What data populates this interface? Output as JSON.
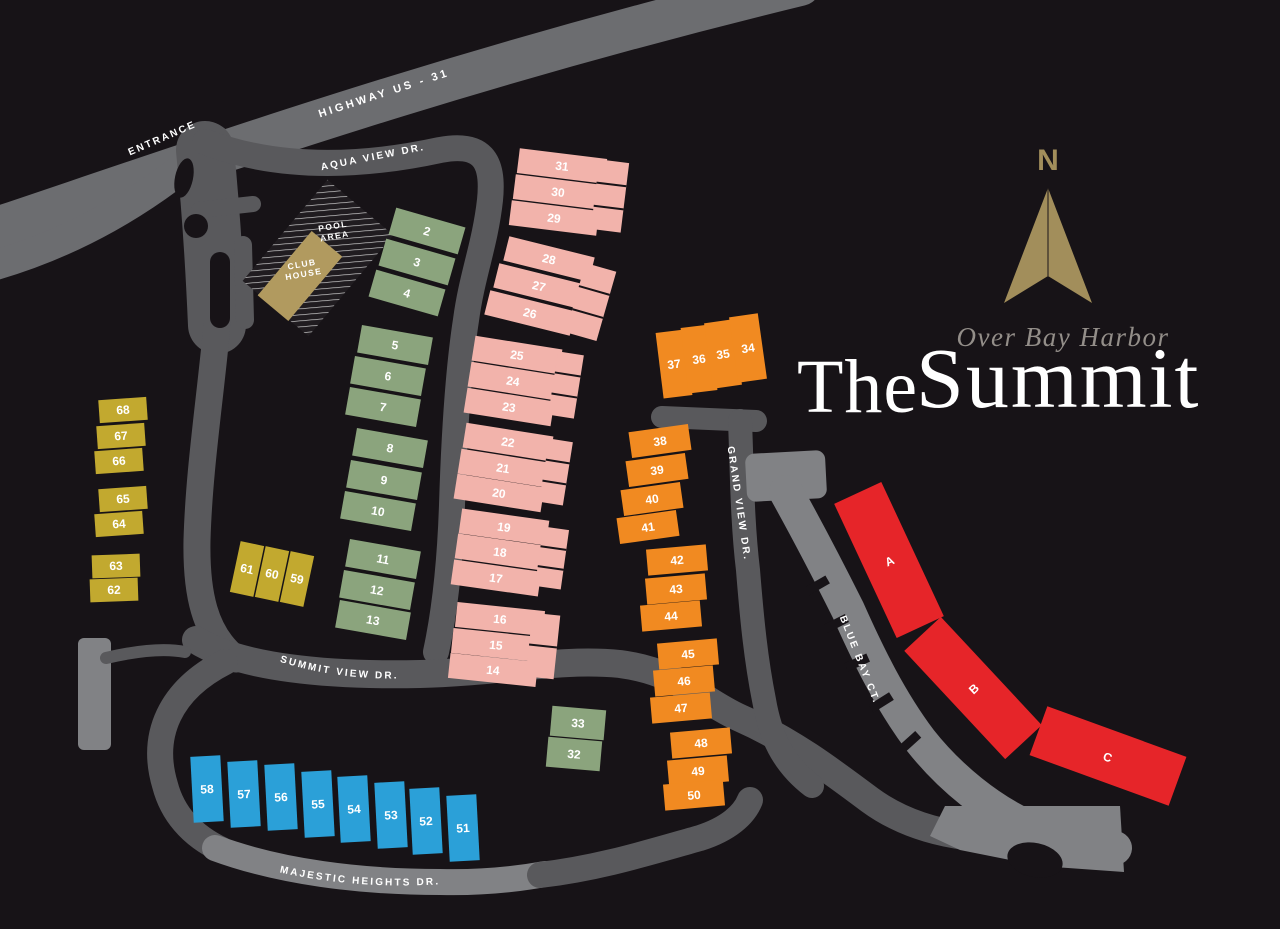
{
  "brand": {
    "the": "The",
    "name": "Summit",
    "script": "Over Bay Harbor",
    "compass_n": "N"
  },
  "poi": {
    "pool_line1": "POOL",
    "pool_line2": "AREA",
    "club_line1": "CLUB",
    "club_line2": "HOUSE"
  },
  "roads": {
    "highway": {
      "label": "HIGHWAY US - 31"
    },
    "entrance": {
      "label": "ENTRANCE"
    },
    "aqua": {
      "label": "AQUA VIEW DR."
    },
    "grand": {
      "label": "GRAND VIEW DR."
    },
    "summit": {
      "label": "SUMMIT VIEW DR."
    },
    "majestic": {
      "label": "MAJESTIC HEIGHTS DR."
    },
    "bluebay": {
      "label": "BLUE BAY CT."
    }
  },
  "colors": {
    "bg": "#171317",
    "p": "#f2b3ab",
    "g": "#8ba47d",
    "o": "#f18a21",
    "y": "#c2a92f",
    "b": "#2ba0d8",
    "r": "#e62529",
    "t": "#b19a5f",
    "gold": "#a28e5b",
    "script": "#938e89",
    "roadDark": "#59595c",
    "roadMid": "#6c6d70",
    "roadLight": "#818285",
    "white": "#ffffff"
  },
  "buildings": [
    {
      "label": "2",
      "x": 427,
      "y": 231,
      "w": 72,
      "h": 28,
      "r": 16,
      "c": "g"
    },
    {
      "label": "3",
      "x": 417,
      "y": 262,
      "w": 72,
      "h": 28,
      "r": 16,
      "c": "g"
    },
    {
      "label": "4",
      "x": 407,
      "y": 293,
      "w": 72,
      "h": 28,
      "r": 16,
      "c": "g"
    },
    {
      "label": "5",
      "x": 395,
      "y": 345,
      "w": 72,
      "h": 28,
      "r": 10,
      "c": "g"
    },
    {
      "label": "6",
      "x": 388,
      "y": 376,
      "w": 72,
      "h": 28,
      "r": 10,
      "c": "g"
    },
    {
      "label": "7",
      "x": 383,
      "y": 407,
      "w": 72,
      "h": 28,
      "r": 10,
      "c": "g"
    },
    {
      "label": "8",
      "x": 390,
      "y": 448,
      "w": 72,
      "h": 28,
      "r": 10,
      "c": "g"
    },
    {
      "label": "9",
      "x": 384,
      "y": 480,
      "w": 72,
      "h": 28,
      "r": 10,
      "c": "g"
    },
    {
      "label": "10",
      "x": 378,
      "y": 511,
      "w": 72,
      "h": 28,
      "r": 10,
      "c": "g"
    },
    {
      "label": "11",
      "x": 383,
      "y": 559,
      "w": 72,
      "h": 28,
      "r": 10,
      "c": "g"
    },
    {
      "label": "12",
      "x": 377,
      "y": 590,
      "w": 72,
      "h": 28,
      "r": 10,
      "c": "g"
    },
    {
      "label": "13",
      "x": 373,
      "y": 620,
      "w": 72,
      "h": 28,
      "r": 10,
      "c": "g"
    },
    {
      "label": "33",
      "x": 578,
      "y": 723,
      "w": 54,
      "h": 30,
      "r": 5,
      "c": "g"
    },
    {
      "label": "32",
      "x": 574,
      "y": 754,
      "w": 54,
      "h": 30,
      "r": 5,
      "c": "g"
    },
    {
      "label": "31",
      "x": 562,
      "y": 166,
      "w": 88,
      "h": 25,
      "r": 7,
      "c": "p"
    },
    {
      "label": "30",
      "x": 558,
      "y": 192,
      "w": 88,
      "h": 25,
      "r": 7,
      "c": "p"
    },
    {
      "label": "29",
      "x": 554,
      "y": 218,
      "w": 88,
      "h": 25,
      "r": 7,
      "c": "p"
    },
    {
      "label": "",
      "x": 610,
      "y": 196,
      "w": 30,
      "h": 70,
      "r": 7,
      "c": "p",
      "cells": 3
    },
    {
      "label": "28",
      "x": 549,
      "y": 259,
      "w": 88,
      "h": 25,
      "r": 14,
      "c": "p"
    },
    {
      "label": "27",
      "x": 539,
      "y": 286,
      "w": 88,
      "h": 25,
      "r": 14,
      "c": "p"
    },
    {
      "label": "26",
      "x": 530,
      "y": 313,
      "w": 88,
      "h": 25,
      "r": 14,
      "c": "p"
    },
    {
      "label": "",
      "x": 591,
      "y": 302,
      "w": 32,
      "h": 72,
      "r": 16,
      "c": "p",
      "cells": 3
    },
    {
      "label": "25",
      "x": 517,
      "y": 355,
      "w": 88,
      "h": 25,
      "r": 9,
      "c": "p"
    },
    {
      "label": "24",
      "x": 513,
      "y": 381,
      "w": 88,
      "h": 25,
      "r": 9,
      "c": "p"
    },
    {
      "label": "23",
      "x": 509,
      "y": 407,
      "w": 88,
      "h": 25,
      "r": 9,
      "c": "p"
    },
    {
      "label": "",
      "x": 566,
      "y": 385,
      "w": 26,
      "h": 64,
      "r": 9,
      "c": "p",
      "cells": 3
    },
    {
      "label": "22",
      "x": 508,
      "y": 442,
      "w": 88,
      "h": 25,
      "r": 9,
      "c": "p"
    },
    {
      "label": "21",
      "x": 503,
      "y": 468,
      "w": 88,
      "h": 25,
      "r": 9,
      "c": "p"
    },
    {
      "label": "20",
      "x": 499,
      "y": 493,
      "w": 88,
      "h": 25,
      "r": 9,
      "c": "p"
    },
    {
      "label": "",
      "x": 556,
      "y": 472,
      "w": 24,
      "h": 64,
      "r": 9,
      "c": "p",
      "cells": 3
    },
    {
      "label": "19",
      "x": 504,
      "y": 527,
      "w": 88,
      "h": 25,
      "r": 8,
      "c": "p"
    },
    {
      "label": "18",
      "x": 500,
      "y": 552,
      "w": 88,
      "h": 25,
      "r": 8,
      "c": "p"
    },
    {
      "label": "17",
      "x": 496,
      "y": 578,
      "w": 88,
      "h": 25,
      "r": 8,
      "c": "p"
    },
    {
      "label": "",
      "x": 552,
      "y": 558,
      "w": 26,
      "h": 60,
      "r": 8,
      "c": "p",
      "cells": 3
    },
    {
      "label": "16",
      "x": 500,
      "y": 619,
      "w": 88,
      "h": 25,
      "r": 6,
      "c": "p"
    },
    {
      "label": "15",
      "x": 496,
      "y": 645,
      "w": 88,
      "h": 25,
      "r": 6,
      "c": "p"
    },
    {
      "label": "14",
      "x": 493,
      "y": 670,
      "w": 88,
      "h": 25,
      "r": 6,
      "c": "p"
    },
    {
      "label": "",
      "x": 543,
      "y": 646,
      "w": 28,
      "h": 64,
      "r": 6,
      "c": "p",
      "cells": 2
    },
    {
      "label": "37",
      "x": 674,
      "y": 364,
      "w": 29,
      "h": 66,
      "r": -7,
      "c": "o"
    },
    {
      "label": "36",
      "x": 699,
      "y": 359,
      "w": 29,
      "h": 66,
      "r": -7,
      "c": "o"
    },
    {
      "label": "35",
      "x": 723,
      "y": 354,
      "w": 29,
      "h": 66,
      "r": -8,
      "c": "o"
    },
    {
      "label": "34",
      "x": 748,
      "y": 348,
      "w": 29,
      "h": 66,
      "r": -8,
      "c": "o"
    },
    {
      "label": "38",
      "x": 660,
      "y": 441,
      "w": 60,
      "h": 26,
      "r": -8,
      "c": "o"
    },
    {
      "label": "39",
      "x": 657,
      "y": 470,
      "w": 60,
      "h": 26,
      "r": -8,
      "c": "o"
    },
    {
      "label": "40",
      "x": 652,
      "y": 499,
      "w": 60,
      "h": 26,
      "r": -8,
      "c": "o"
    },
    {
      "label": "41",
      "x": 648,
      "y": 527,
      "w": 60,
      "h": 26,
      "r": -8,
      "c": "o"
    },
    {
      "label": "42",
      "x": 677,
      "y": 560,
      "w": 60,
      "h": 26,
      "r": -5,
      "c": "o"
    },
    {
      "label": "43",
      "x": 676,
      "y": 589,
      "w": 60,
      "h": 26,
      "r": -5,
      "c": "o"
    },
    {
      "label": "44",
      "x": 671,
      "y": 616,
      "w": 60,
      "h": 26,
      "r": -5,
      "c": "o"
    },
    {
      "label": "45",
      "x": 688,
      "y": 654,
      "w": 60,
      "h": 26,
      "r": -5,
      "c": "o"
    },
    {
      "label": "46",
      "x": 684,
      "y": 681,
      "w": 60,
      "h": 26,
      "r": -5,
      "c": "o"
    },
    {
      "label": "47",
      "x": 681,
      "y": 708,
      "w": 60,
      "h": 26,
      "r": -5,
      "c": "o"
    },
    {
      "label": "48",
      "x": 701,
      "y": 743,
      "w": 60,
      "h": 26,
      "r": -5,
      "c": "o"
    },
    {
      "label": "49",
      "x": 698,
      "y": 771,
      "w": 60,
      "h": 26,
      "r": -5,
      "c": "o"
    },
    {
      "label": "50",
      "x": 694,
      "y": 795,
      "w": 60,
      "h": 26,
      "r": -5,
      "c": "o"
    },
    {
      "label": "58",
      "x": 207,
      "y": 789,
      "w": 30,
      "h": 66,
      "r": -3,
      "c": "b"
    },
    {
      "label": "57",
      "x": 244,
      "y": 794,
      "w": 30,
      "h": 66,
      "r": -3,
      "c": "b"
    },
    {
      "label": "56",
      "x": 281,
      "y": 797,
      "w": 30,
      "h": 66,
      "r": -3,
      "c": "b"
    },
    {
      "label": "55",
      "x": 318,
      "y": 804,
      "w": 30,
      "h": 66,
      "r": -3,
      "c": "b"
    },
    {
      "label": "54",
      "x": 354,
      "y": 809,
      "w": 30,
      "h": 66,
      "r": -3,
      "c": "b"
    },
    {
      "label": "53",
      "x": 391,
      "y": 815,
      "w": 30,
      "h": 66,
      "r": -3,
      "c": "b"
    },
    {
      "label": "52",
      "x": 426,
      "y": 821,
      "w": 30,
      "h": 66,
      "r": -3,
      "c": "b"
    },
    {
      "label": "51",
      "x": 463,
      "y": 828,
      "w": 30,
      "h": 66,
      "r": -3,
      "c": "b"
    },
    {
      "label": "68",
      "x": 123,
      "y": 410,
      "w": 48,
      "h": 23,
      "r": -4,
      "c": "y",
      "fs": 11
    },
    {
      "label": "67",
      "x": 121,
      "y": 436,
      "w": 48,
      "h": 23,
      "r": -4,
      "c": "y",
      "fs": 11
    },
    {
      "label": "66",
      "x": 119,
      "y": 461,
      "w": 48,
      "h": 23,
      "r": -4,
      "c": "y",
      "fs": 11
    },
    {
      "label": "65",
      "x": 123,
      "y": 499,
      "w": 48,
      "h": 23,
      "r": -4,
      "c": "y",
      "fs": 11
    },
    {
      "label": "64",
      "x": 119,
      "y": 524,
      "w": 48,
      "h": 23,
      "r": -4,
      "c": "y",
      "fs": 11
    },
    {
      "label": "63",
      "x": 116,
      "y": 566,
      "w": 48,
      "h": 23,
      "r": -2,
      "c": "y",
      "fs": 11
    },
    {
      "label": "62",
      "x": 114,
      "y": 590,
      "w": 48,
      "h": 23,
      "r": -2,
      "c": "y",
      "fs": 11
    },
    {
      "label": "61",
      "x": 247,
      "y": 569,
      "w": 24,
      "h": 52,
      "r": 12,
      "c": "y",
      "fs": 11
    },
    {
      "label": "60",
      "x": 272,
      "y": 574,
      "w": 24,
      "h": 52,
      "r": 12,
      "c": "y",
      "fs": 11
    },
    {
      "label": "59",
      "x": 297,
      "y": 579,
      "w": 24,
      "h": 52,
      "r": 12,
      "c": "y",
      "fs": 11
    },
    {
      "label": "A",
      "x": 889,
      "y": 560,
      "w": 52,
      "h": 148,
      "r": -25,
      "c": "r",
      "fs": 15
    },
    {
      "label": "B",
      "x": 973,
      "y": 688,
      "w": 50,
      "h": 148,
      "r": -43,
      "c": "r",
      "fs": 15
    },
    {
      "label": "C",
      "x": 1108,
      "y": 756,
      "w": 148,
      "h": 52,
      "r": 20,
      "c": "r",
      "fs": 15
    }
  ]
}
